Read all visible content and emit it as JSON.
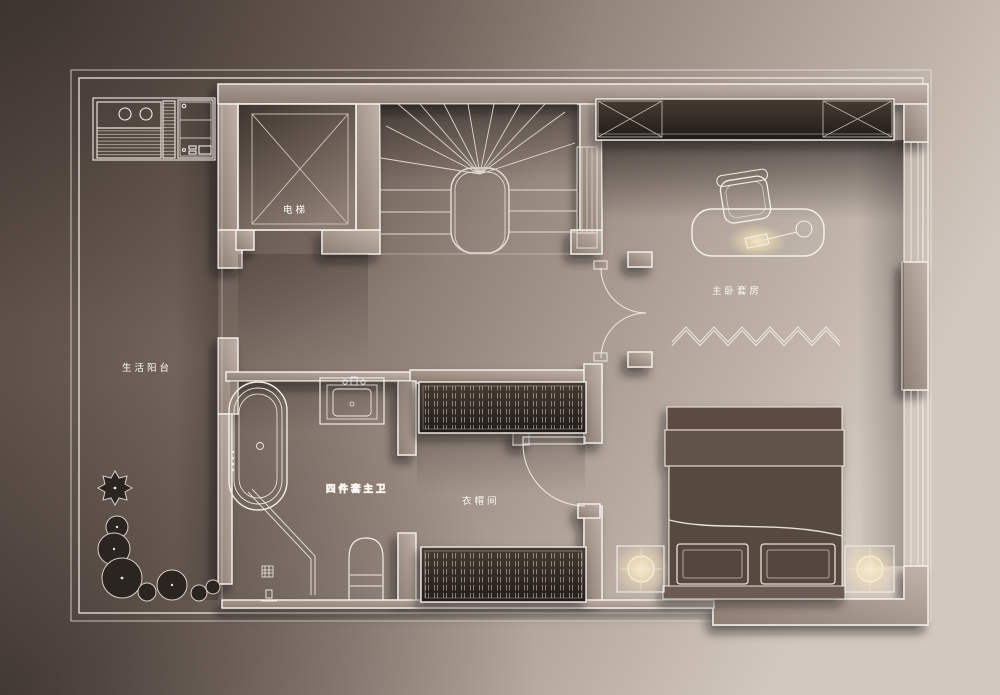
{
  "plan": {
    "labels": {
      "elevator": "电梯",
      "balcony": "生活阳台",
      "bathroom": "四件套主卫",
      "cloakroom": "衣帽间",
      "master_suite": "主卧套房"
    },
    "colors": {
      "bg_dark": "#51453e",
      "bg_light": "#d3c8bf",
      "floor_mid": "#8d7d73",
      "line_white": "#f5f0ea",
      "wall_light": "#c0b3a9",
      "wall_dark": "#8d7d73",
      "fixture_dark": "#352d27",
      "lamp_glow": "#f8ecca",
      "plant": "#2b2522",
      "bed": "#574940"
    }
  }
}
